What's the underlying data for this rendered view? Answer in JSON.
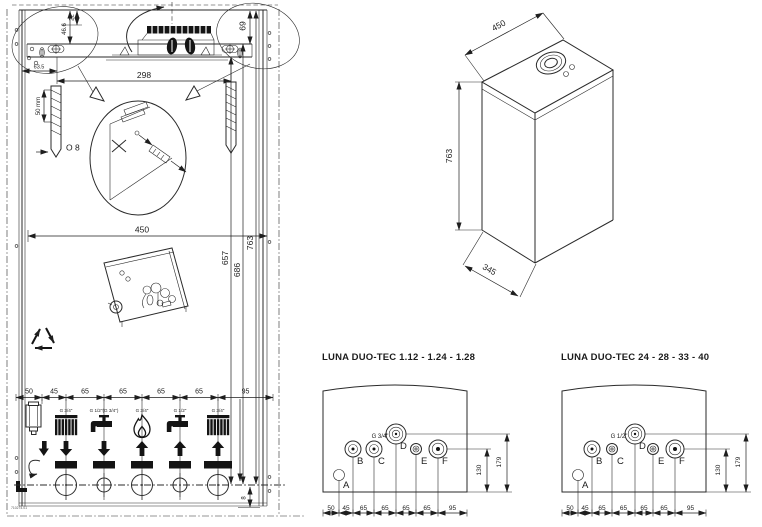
{
  "wall_template": {
    "dims": {
      "top_small": "22",
      "top_mid": "46.6",
      "top_right": "69",
      "bracket_left": "63.5",
      "holes_span": "298",
      "drill_depth": "50 mm",
      "drill_dia": "O 8",
      "width": "450",
      "h1": "657",
      "h2": "686",
      "h3": "763",
      "bottom": [
        "50",
        "45",
        "65",
        "65",
        "65",
        "65",
        "95"
      ],
      "edge_gap": "8"
    },
    "fittings": [
      {
        "label": "G 3/4\""
      },
      {
        "label": "G 1/2\"(G 3/4\")"
      },
      {
        "label": "G 3/4\""
      },
      {
        "label": "G 1/2\""
      },
      {
        "label": "G 3/4\""
      }
    ],
    "part_code": "710274.01"
  },
  "boiler_view": {
    "width": "450",
    "height": "763",
    "depth": "345"
  },
  "connection_diagrams": [
    {
      "title": "LUNA DUO-TEC  1.12 - 1.24 - 1.28",
      "pipe_label": "G 3/4\"",
      "points": {
        "a": "A",
        "b": "B",
        "c": "C",
        "d": "D",
        "e": "E",
        "f": "F"
      },
      "bottom": [
        "50",
        "45",
        "65",
        "65",
        "65",
        "65",
        "95"
      ],
      "inner_height": "130",
      "outer_height": "179"
    },
    {
      "title": "LUNA DUO-TEC  24 - 28 - 33 - 40",
      "pipe_label": "G 1/2\"",
      "points": {
        "a": "A",
        "b": "B",
        "c": "C",
        "d": "D",
        "e": "E",
        "f": "F"
      },
      "bottom": [
        "50",
        "45",
        "65",
        "65",
        "65",
        "65",
        "95"
      ],
      "inner_height": "130",
      "outer_height": "179"
    }
  ]
}
